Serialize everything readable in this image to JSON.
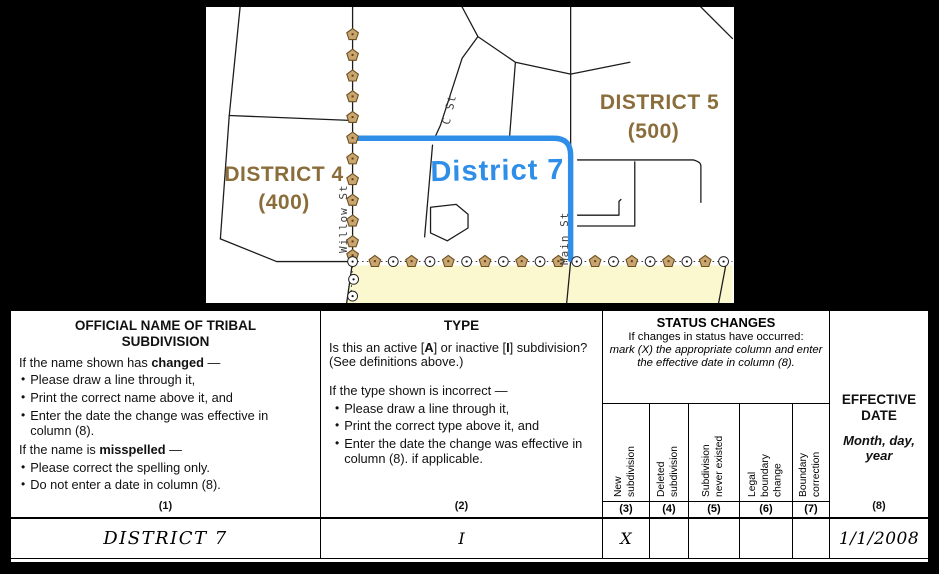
{
  "map": {
    "district4": {
      "name": "DISTRICT 4",
      "code": "(400)"
    },
    "district5": {
      "name": "DISTRICT 5",
      "code": "(500)"
    },
    "district7_label": "District 7",
    "streets": {
      "willow": "Willow St",
      "c": "C St",
      "main": "Main St"
    },
    "colors": {
      "district_label_brown": "#8a6d3b",
      "boundary_blue": "#2f8ee8",
      "exterior_area_yellow": "#fbf7cf",
      "pentagon_marker_fill": "#c9a56f"
    }
  },
  "form": {
    "col1": {
      "title": "OFFICIAL NAME OF TRIBAL SUBDIVISION",
      "changed_pre": "If the name shown has ",
      "changed_word": "changed",
      "changed_post": " —",
      "changed_bullets": [
        "Please draw a line through it,",
        "Print the correct name above it, and",
        "Enter the date the change was effective in column (8)."
      ],
      "misspelled_pre": "If the name is ",
      "misspelled_word": "misspelled",
      "misspelled_post": " —",
      "misspelled_bullets": [
        "Please correct the spelling only.",
        "Do not enter a date in column (8)."
      ],
      "number": "(1)"
    },
    "col2": {
      "title": "TYPE",
      "q_pre": "Is this an active [",
      "q_a": "A",
      "q_mid": "] or inactive [",
      "q_i": "I",
      "q_post": "] subdivision? (See definitions above.)",
      "incorrect_intro": "If the type shown is incorrect —",
      "bullets": [
        "Please draw a line through it,",
        "Print the correct type above it, and",
        "Enter the date the change was effective in column (8). if applicable."
      ],
      "number": "(2)"
    },
    "status": {
      "title": "STATUS CHANGES",
      "intro": "If changes in status have occurred:",
      "instruction": "mark (X) the appropriate column and enter the effective date in column (8).",
      "columns": [
        {
          "label": "New subdivision",
          "number": "(3)"
        },
        {
          "label": "Deleted subdivision",
          "number": "(4)"
        },
        {
          "label": "Subdivision never existed",
          "number": "(5)"
        },
        {
          "label": "Legal boundary change",
          "number": "(6)"
        },
        {
          "label": "Boundary correction",
          "number": "(7)"
        }
      ]
    },
    "col8": {
      "title": "EFFECTIVE DATE",
      "subtitle": "Month, day, year",
      "number": "(8)"
    },
    "row": {
      "name": "DISTRICT 7",
      "type": "I",
      "marks": [
        "X",
        "",
        "",
        "",
        ""
      ],
      "effective_date": "1/1/2008"
    }
  }
}
